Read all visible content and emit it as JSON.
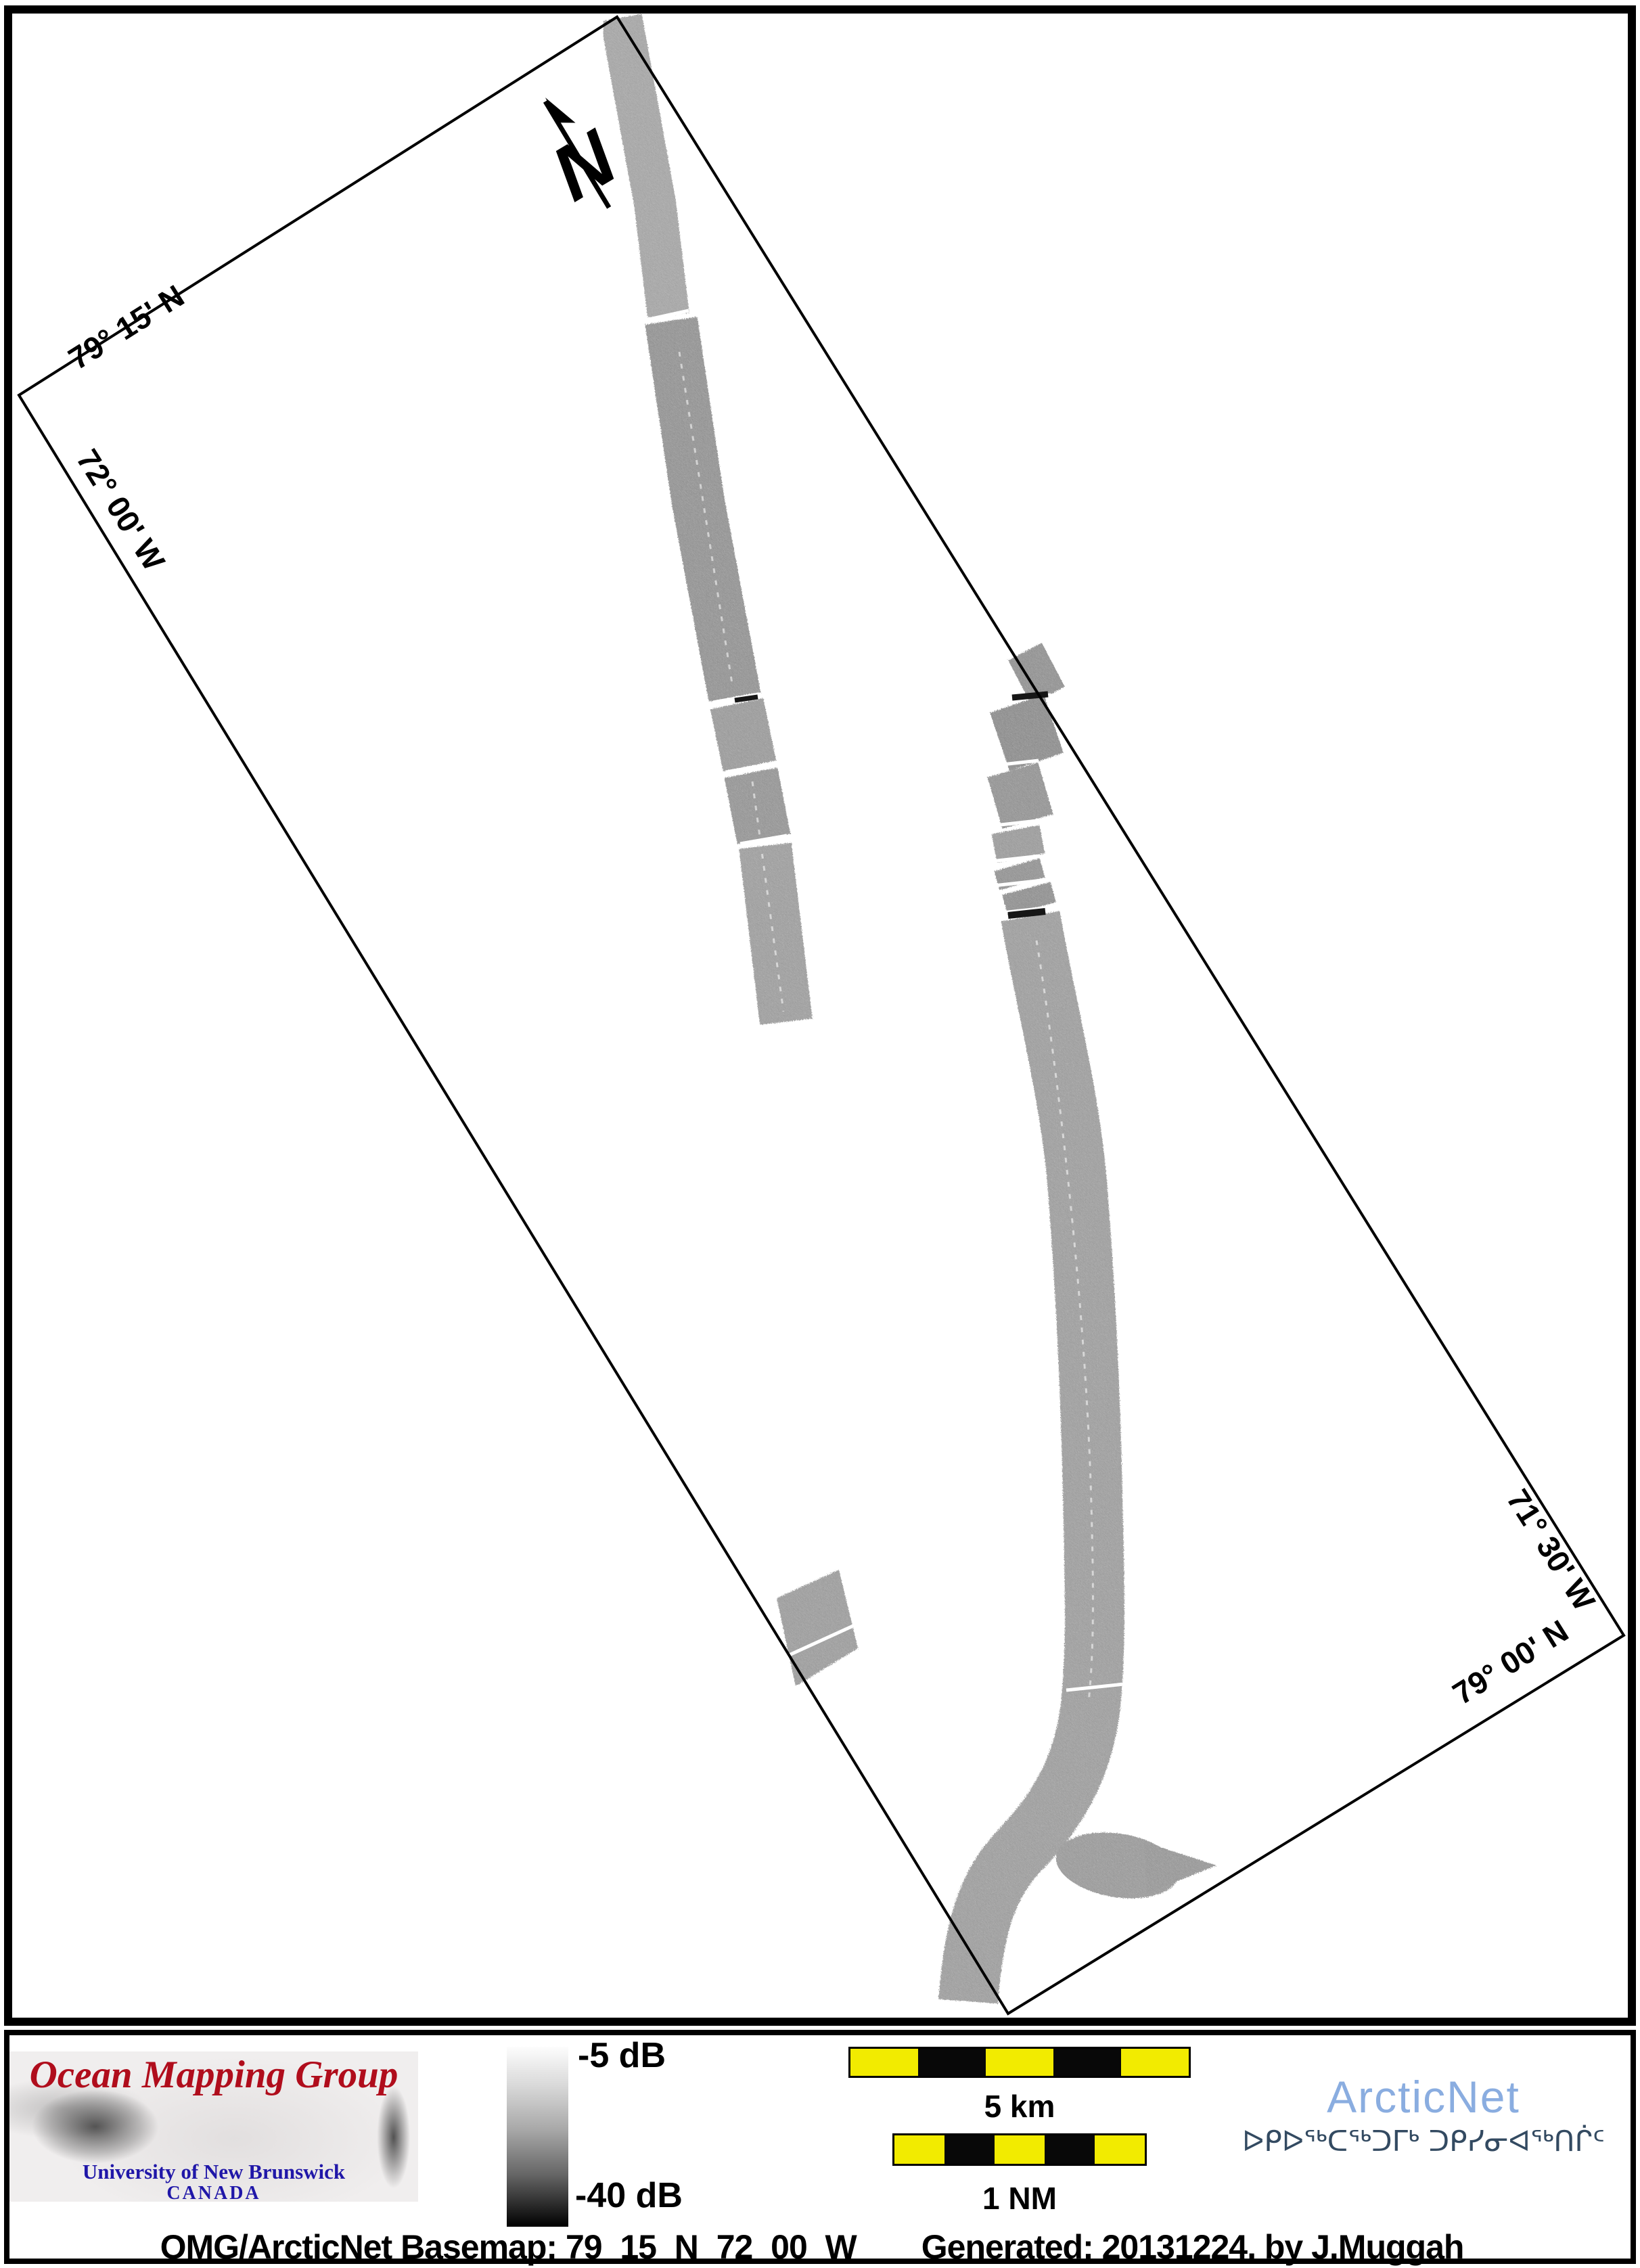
{
  "map": {
    "corner_labels": {
      "lat_top": "79° 15' N",
      "lon_left": "72° 00' W",
      "lon_right": "71° 30' W",
      "lat_bottom": "79° 00' N"
    },
    "north_arrow_label": "N"
  },
  "footer": {
    "logo": {
      "title": "Ocean Mapping Group",
      "institution": "University of New Brunswick",
      "country": "CANADA",
      "title_color": "#b00d1c",
      "text_color": "#2017a8"
    },
    "colorbar": {
      "top_label": "-5 dB",
      "bottom_label": "-40 dB",
      "top_color": "#fdfdfd",
      "bottom_color": "#000000"
    },
    "scale_km": {
      "label": "5 km",
      "segments": 5
    },
    "scale_nm": {
      "label": "1 NM",
      "segments": 5
    },
    "scale_yellow": "#f2eb00",
    "arcticnet": {
      "wordmark": "ArcticNet",
      "inuktitut": "ᐅᑭᐅᖅᑕᖅᑐᒥᒃ ᑐᑭᓯᓂᐊᖅᑎᒌᑦ",
      "wordmark_color": "#8aade0",
      "inuktitut_color": "#334a61"
    },
    "caption": {
      "basemap": "OMG/ArcticNet Basemap: 79_15_N_72_00_W",
      "generated": "Generated: 20131224, by J.Muggah"
    }
  }
}
